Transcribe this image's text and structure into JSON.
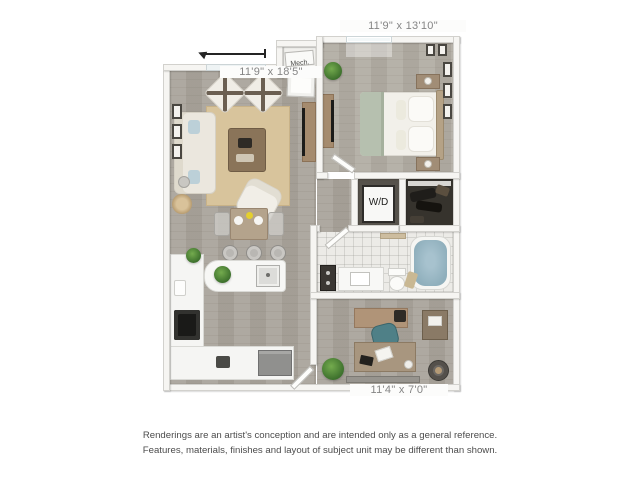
{
  "labels": {
    "bedroom_dims": "11'9\" x 13'10\"",
    "living_dims": "11'9\" x 18'5\"",
    "flex_dims": "11'4\" x 7'0\"",
    "mech_closet": "Mech.",
    "washer_dryer": "W/D"
  },
  "disclaimer": {
    "line1": "Renderings are an artist's conception and are intended only as a general reference.",
    "line2": "Features, materials, finishes and layout of subject unit may be different than shown."
  },
  "colors": {
    "background": "#ffffff",
    "wood_floor": "#a9a49b",
    "bedroom_floor": "#b1aca3",
    "wall": "#f6f5f2",
    "rug": "#d8c49c",
    "tub_water": "#8fafbc",
    "bed_throw": "#b6c0af",
    "accent_wood": "#a58b6e",
    "label_text": "#858585",
    "disclaimer_text": "#4c4c4c"
  }
}
